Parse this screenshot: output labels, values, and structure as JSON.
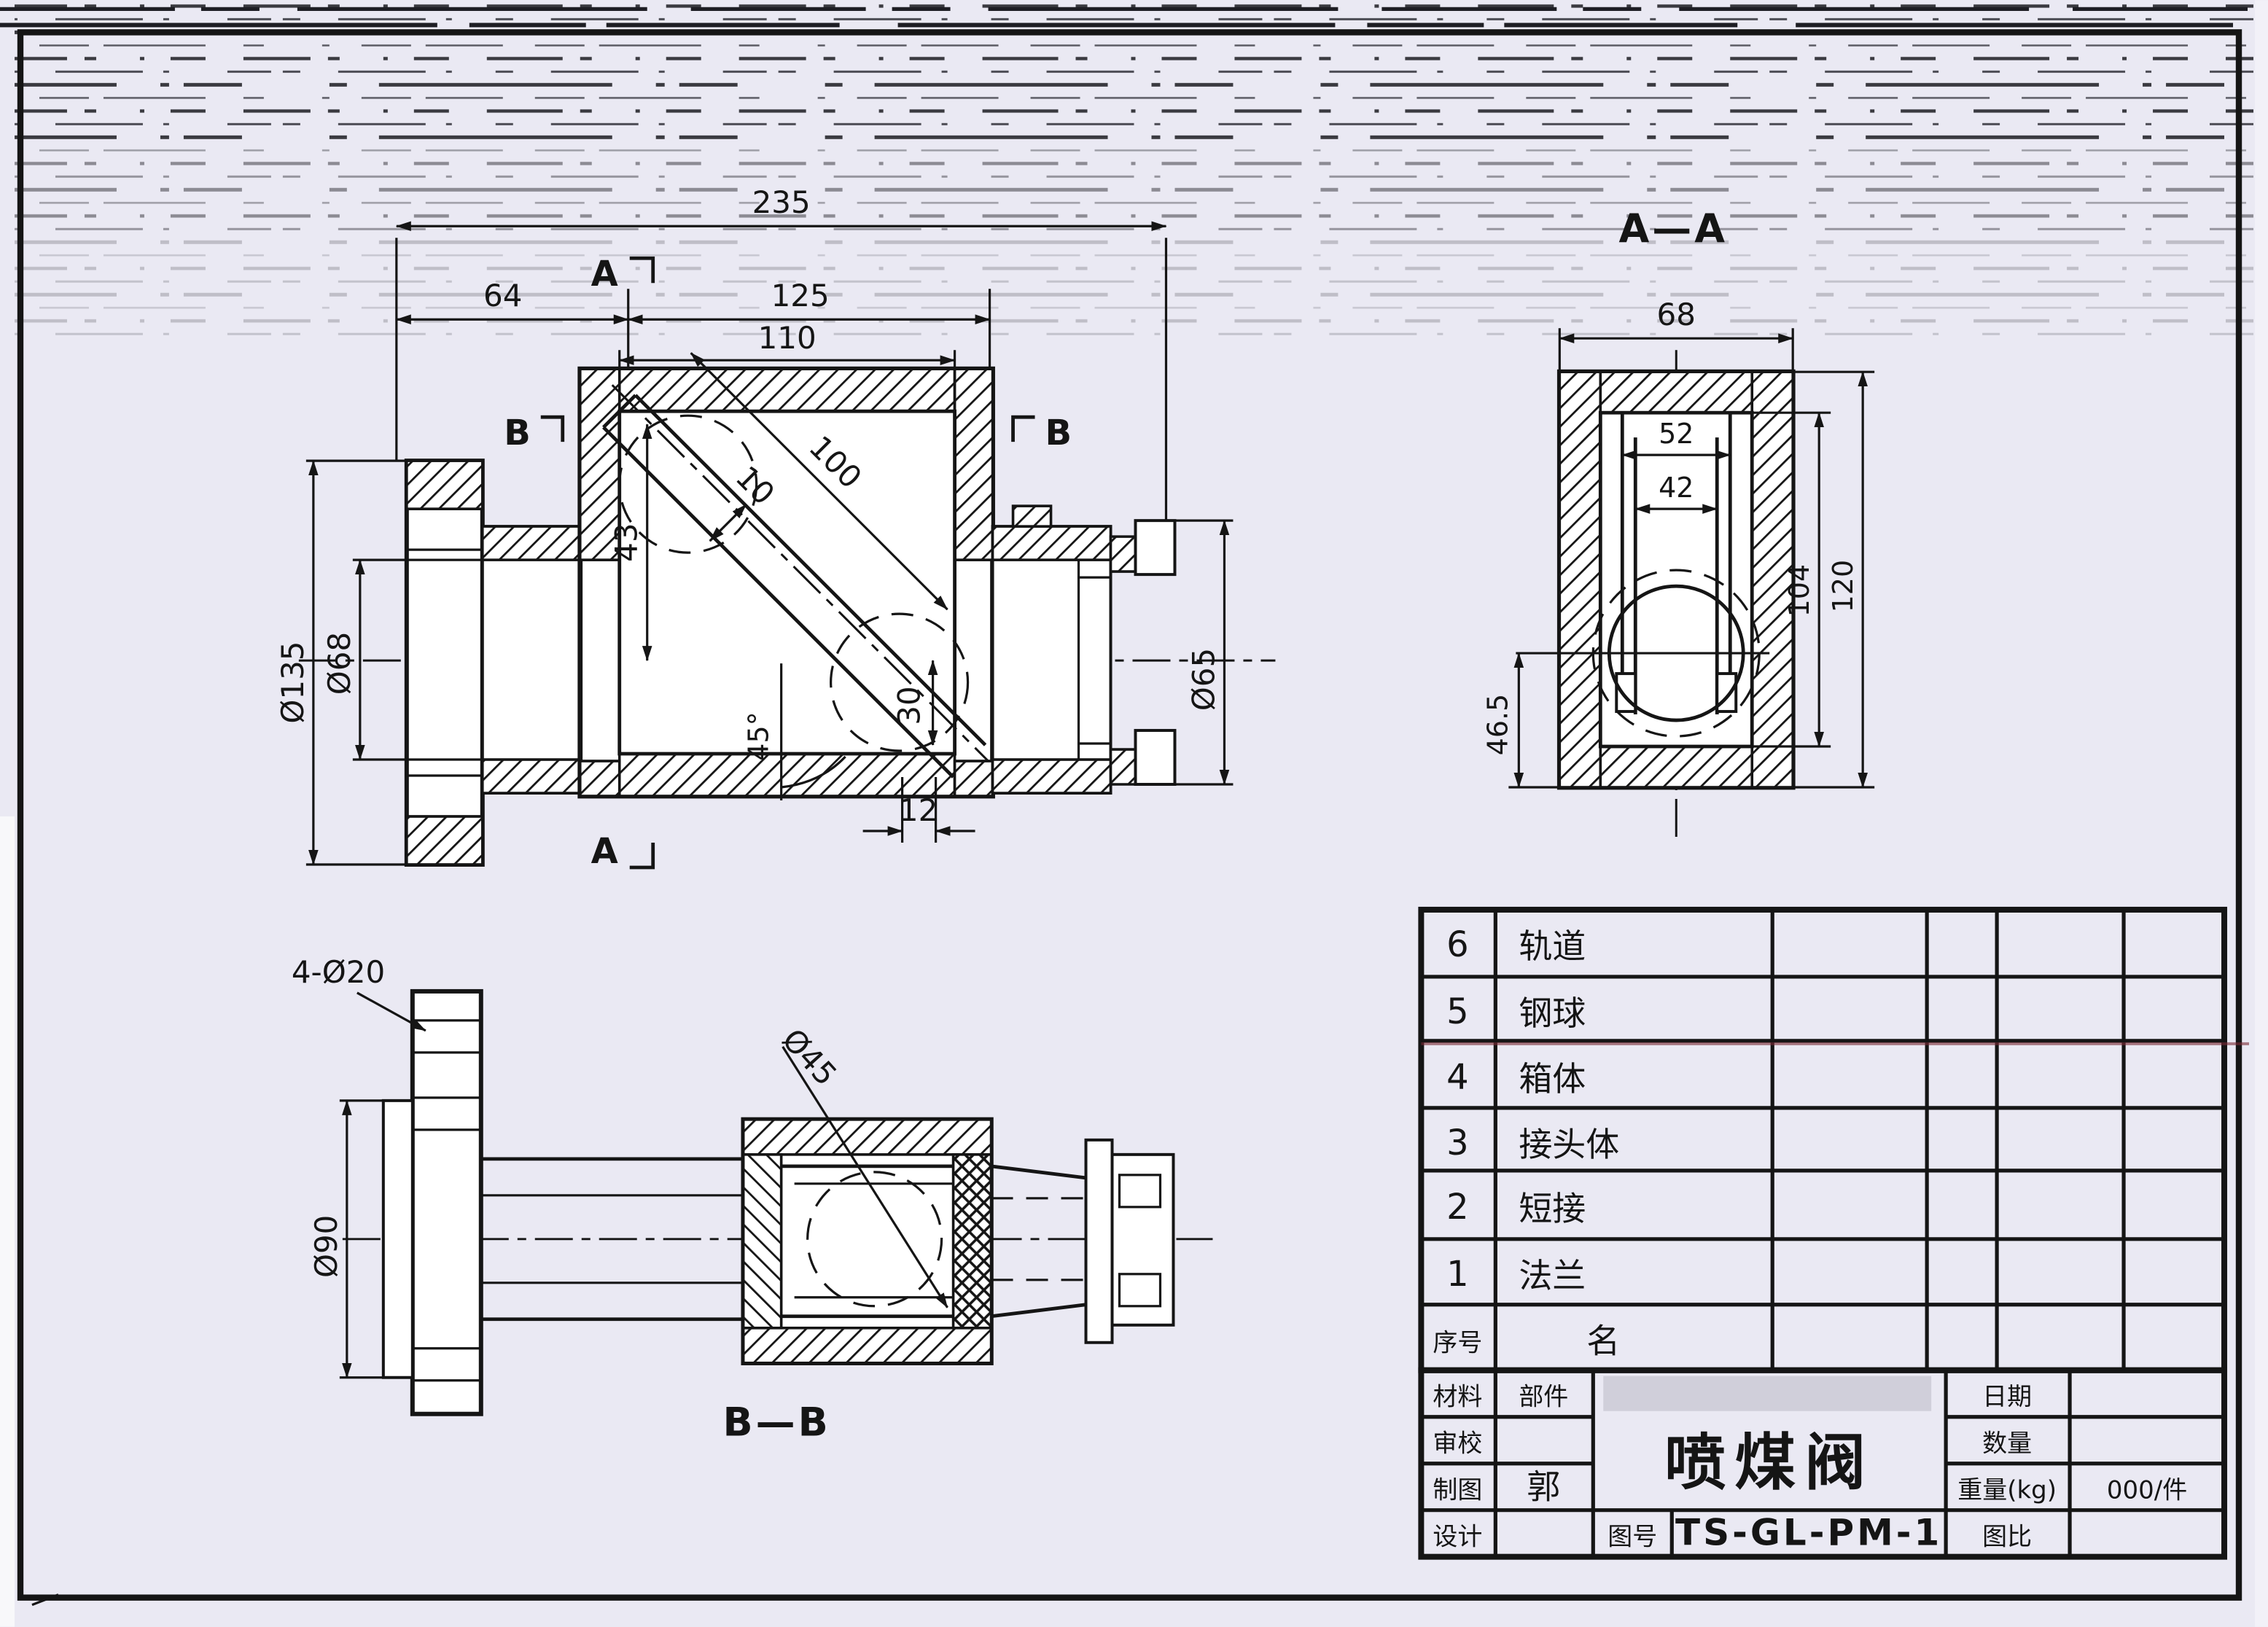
{
  "colors": {
    "paper": "#eae9f3",
    "ink": "#151515",
    "artifact_red": "#7a2a35"
  },
  "front_view": {
    "dim_overall": "235",
    "dim_left": "64",
    "dim_mid": "125",
    "dim_inner": "110",
    "dim_diag": "100",
    "dim_channel_width": "10",
    "dim_vert": "43",
    "dim_offset": "30",
    "dim_angle": "45°",
    "dim_slot": "12",
    "dia_flange": "Ø135",
    "dia_bore": "Ø68",
    "dia_outlet": "Ø65",
    "marker_a": "A",
    "marker_b": "B"
  },
  "section_aa": {
    "title": "A—A",
    "dim_width": "68",
    "dim_rail_outer": "52",
    "dim_rail_inner": "42",
    "dim_inner_height": "104",
    "dim_outer_height": "120",
    "dim_ball_bottom": "46.5"
  },
  "section_bb": {
    "title": "B—B",
    "holes_label": "4-Ø20",
    "dia_ring": "Ø90",
    "dia_ball": "Ø45"
  },
  "parts_table": {
    "header": {
      "no": "序号",
      "name": "名"
    },
    "rows": [
      {
        "no": "6",
        "name": "轨道"
      },
      {
        "no": "5",
        "name": "钢球"
      },
      {
        "no": "4",
        "name": "箱体"
      },
      {
        "no": "3",
        "name": "接头体"
      },
      {
        "no": "2",
        "name": "短接"
      },
      {
        "no": "1",
        "name": "法兰"
      }
    ]
  },
  "title_block": {
    "material_label": "材料",
    "part_label": "部件",
    "check_label": "审校",
    "draft_label": "制图",
    "drafter": "郭",
    "design_label": "设计",
    "product_title": "喷煤阀",
    "drawing_no_label": "图号",
    "drawing_no": "TS-GL-PM-1",
    "date_label": "日期",
    "qty_label": "数量",
    "weight_label": "重量(kg)",
    "weight_value": "000/件",
    "scale_label": "图比"
  }
}
